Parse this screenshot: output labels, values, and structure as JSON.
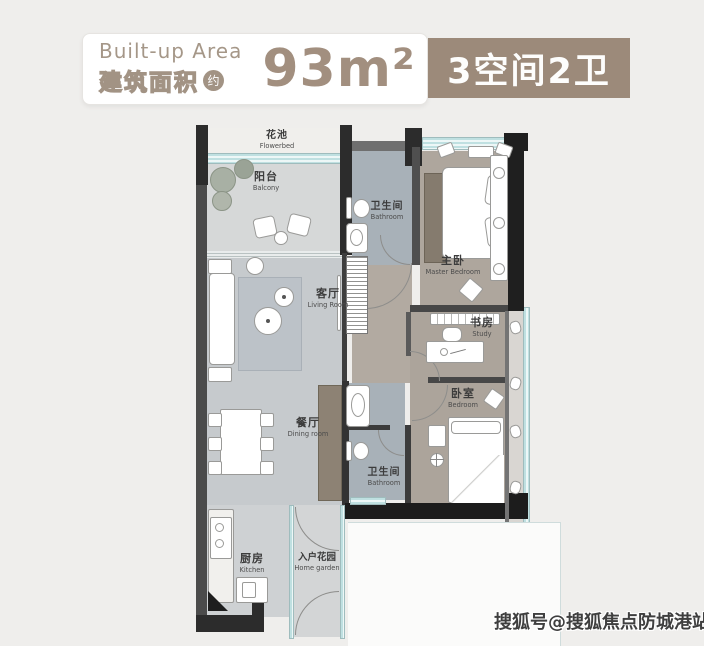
{
  "header": {
    "area_label_en": "Built-up Area",
    "area_label_zh": "建筑面积",
    "approx": "约",
    "area_value": "93m²",
    "spec_badge": "3空间2卫"
  },
  "rooms": {
    "flowerbed": {
      "zh": "花池",
      "en": "Flowerbed"
    },
    "balcony": {
      "zh": "阳台",
      "en": "Balcony"
    },
    "living_room": {
      "zh": "客厅",
      "en": "Living Room"
    },
    "dining_room": {
      "zh": "餐厅",
      "en": "Dining room"
    },
    "kitchen": {
      "zh": "厨房",
      "en": "Kitchen"
    },
    "home_garden": {
      "zh": "入户花园",
      "en": "Home garden"
    },
    "bathroom_upper": {
      "zh": "卫生间",
      "en": "Bathroom"
    },
    "bathroom_lower": {
      "zh": "卫生间",
      "en": "Bathroom"
    },
    "master_bedroom": {
      "zh": "主卧",
      "en": "Master Bedroom"
    },
    "study": {
      "zh": "书房",
      "en": "Study"
    },
    "bedroom": {
      "zh": "卧室",
      "en": "Bedroom"
    }
  },
  "watermark": "搜狐号@搜狐焦点防城港站",
  "colors": {
    "badge_brown": "#9c8a7a",
    "area_text": "#a28f7f",
    "wall_dark": "#2c2c2c",
    "window_teal": "#bfe0e1",
    "floor_gray": "#c6cacd",
    "floor_taupe": "#aca49b",
    "floor_tile": "#a8b1b8"
  }
}
